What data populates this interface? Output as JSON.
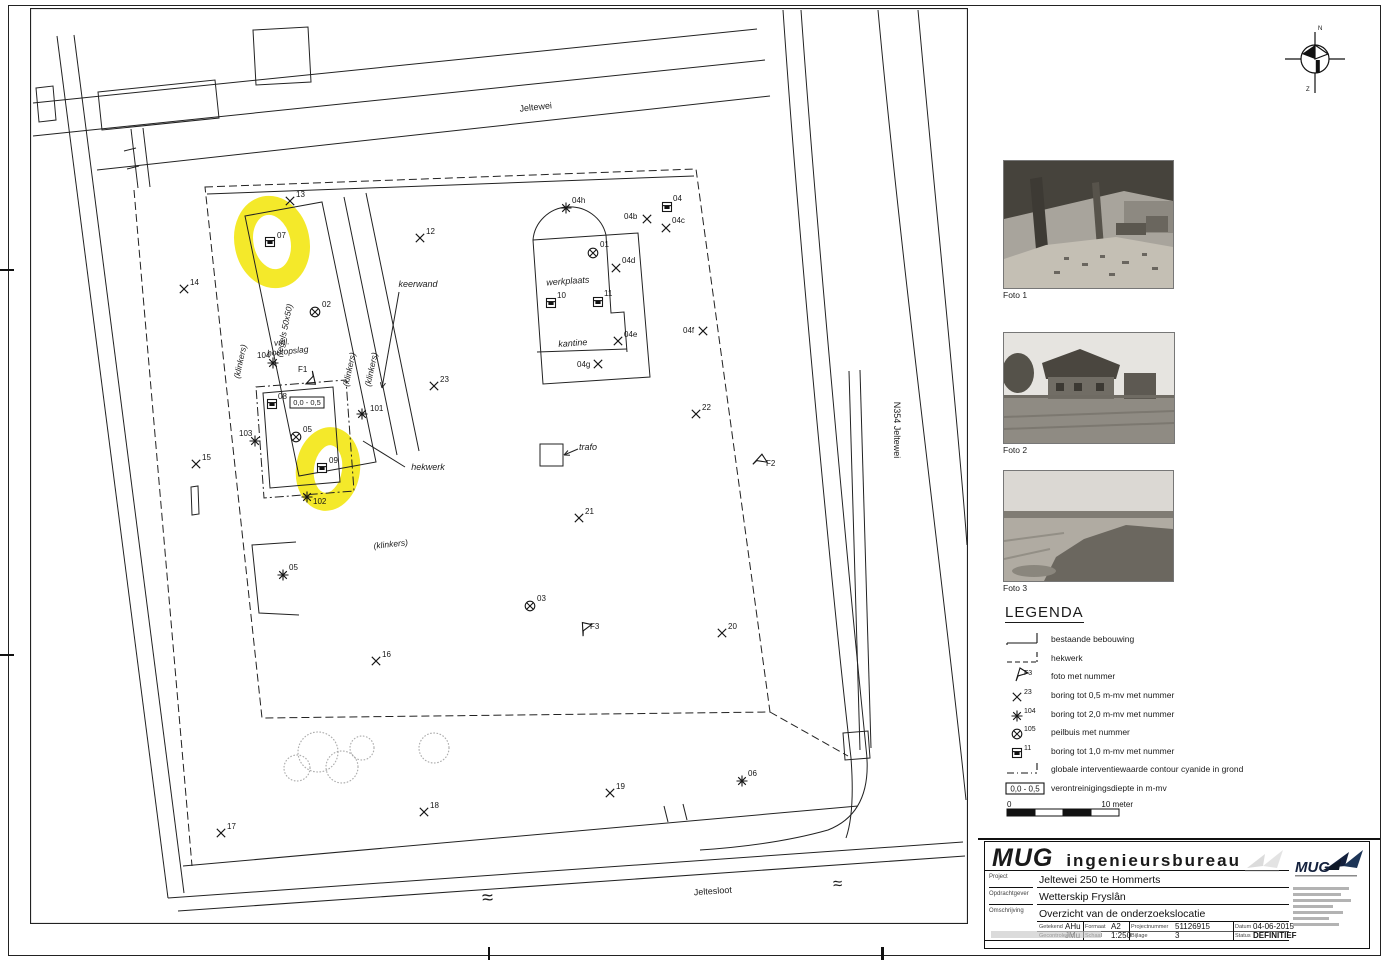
{
  "north": {
    "top": "N",
    "bottom": "Z"
  },
  "photos": [
    {
      "caption": "Foto 1"
    },
    {
      "caption": "Foto 2"
    },
    {
      "caption": "Foto 3"
    }
  ],
  "legend": {
    "title": "LEGENDA",
    "items": [
      {
        "sym": "bldg",
        "num": "",
        "label": "bestaande bebouwing"
      },
      {
        "sym": "fence",
        "num": "",
        "label": "hekwerk"
      },
      {
        "sym": "flag",
        "num": "F3",
        "label": "foto met nummer"
      },
      {
        "sym": "x",
        "num": "23",
        "label": "boring tot 0,5 m-mv met nummer"
      },
      {
        "sym": "star",
        "num": "104",
        "label": "boring tot 2,0 m-mv met nummer"
      },
      {
        "sym": "pb",
        "num": "105",
        "label": "peilbuis met nummer"
      },
      {
        "sym": "sq",
        "num": "11",
        "label": "boring tot 1,0 m-mv met nummer"
      },
      {
        "sym": "contour",
        "num": "",
        "label": "globale interventiewaarde contour cyanide in grond"
      },
      {
        "sym": "depth",
        "num": "0,0 - 0,5",
        "label": "verontreinigingsdiepte in m-mv"
      }
    ],
    "scale": {
      "left": "0",
      "right": "10 meter"
    }
  },
  "titleblock": {
    "company": "MUG",
    "company2": "ingenieursbureau",
    "logo": "MUG",
    "rows": [
      {
        "label": "Project",
        "value": "Jeltewei 250 te Hommerts"
      },
      {
        "label": "Opdrachtgever",
        "value": "Wetterskip Fryslân"
      },
      {
        "label": "Omschrijving",
        "value": "Overzicht van de onderzoekslocatie"
      }
    ],
    "fields": [
      [
        {
          "label": "Getekend",
          "value": "AHu"
        },
        {
          "label": "Formaat",
          "value": "A2"
        },
        {
          "label": "Projectnummer",
          "value": "51126915"
        },
        {
          "label": "Datum",
          "value": "04-06-2015"
        }
      ],
      [
        {
          "label": "Gecontroleerd",
          "value": "JMu"
        },
        {
          "label": "Schaal",
          "value": "1:250"
        },
        {
          "label": "Bijlage",
          "value": "3"
        },
        {
          "label": "Status",
          "value": "DEFINITIEF"
        }
      ]
    ]
  },
  "map": {
    "highlight_color": "#f3e713",
    "labels": [
      {
        "text": "Jeltewei",
        "x": 536,
        "y": 110,
        "rot": -6,
        "italic": false,
        "size": 9
      },
      {
        "text": "N354  Jeltewei",
        "x": 894,
        "y": 430,
        "rot": 90,
        "italic": false,
        "size": 9
      },
      {
        "text": "Jeltesloot",
        "x": 713,
        "y": 894,
        "rot": -4,
        "italic": false,
        "size": 9
      },
      {
        "text": "werkplaats",
        "x": 568,
        "y": 284,
        "rot": -4,
        "italic": true,
        "size": 9
      },
      {
        "text": "kantine",
        "x": 573,
        "y": 346,
        "rot": -4,
        "italic": true,
        "size": 9
      },
      {
        "text": "trafo",
        "x": 588,
        "y": 450,
        "rot": 0,
        "italic": true,
        "size": 9
      },
      {
        "text": "keerwand",
        "x": 418,
        "y": 287,
        "rot": 0,
        "italic": true,
        "size": 9
      },
      {
        "text": "hekwerk",
        "x": 428,
        "y": 470,
        "rot": 0,
        "italic": true,
        "size": 9
      },
      {
        "text": "(klinkers)",
        "x": 243,
        "y": 362,
        "rot": -78,
        "italic": true,
        "size": 8.5
      },
      {
        "text": "(klinkers)",
        "x": 352,
        "y": 370,
        "rot": -78,
        "italic": true,
        "size": 8.5
      },
      {
        "text": "(klinkers)",
        "x": 374,
        "y": 370,
        "rot": -78,
        "italic": true,
        "size": 8.5
      },
      {
        "text": "(klinkers)",
        "x": 391,
        "y": 547,
        "rot": -6,
        "italic": true,
        "size": 8.5
      },
      {
        "text": "(tegels 50x50)",
        "x": 287,
        "y": 331,
        "rot": -78,
        "italic": true,
        "size": 8.5
      },
      {
        "text": "vml.",
        "x": 282,
        "y": 345,
        "rot": -6,
        "italic": true,
        "size": 8.5
      },
      {
        "text": "houtopslag",
        "x": 288,
        "y": 354,
        "rot": -6,
        "italic": true,
        "size": 8.5
      },
      {
        "text": "≈",
        "x": 488,
        "y": 904,
        "rot": -4,
        "italic": false,
        "size": 20
      },
      {
        "text": "≈",
        "x": 838,
        "y": 889,
        "rot": -4,
        "italic": false,
        "size": 17
      }
    ],
    "boxed": [
      {
        "text": "0,0 - 0,5",
        "x": 290,
        "y": 397,
        "w": 34,
        "h": 11
      }
    ],
    "leaders": [
      {
        "x1": 578,
        "y1": 449,
        "x2": 564,
        "y2": 455,
        "arrow": true
      },
      {
        "x1": 399,
        "y1": 292,
        "x2": 382,
        "y2": 388,
        "arrow": true
      },
      {
        "x1": 405,
        "y1": 467,
        "x2": 363,
        "y2": 441,
        "arrow": false
      }
    ],
    "markers": [
      {
        "t": "x",
        "x": 420,
        "y": 238,
        "n": "12",
        "lx": 426,
        "ly": 234
      },
      {
        "t": "x",
        "x": 290,
        "y": 201,
        "n": "13",
        "lx": 296,
        "ly": 197
      },
      {
        "t": "x",
        "x": 184,
        "y": 289,
        "n": "14",
        "lx": 190,
        "ly": 285
      },
      {
        "t": "x",
        "x": 196,
        "y": 464,
        "n": "15",
        "lx": 202,
        "ly": 460
      },
      {
        "t": "x",
        "x": 376,
        "y": 661,
        "n": "16",
        "lx": 382,
        "ly": 657
      },
      {
        "t": "x",
        "x": 221,
        "y": 833,
        "n": "17",
        "lx": 227,
        "ly": 829
      },
      {
        "t": "x",
        "x": 424,
        "y": 812,
        "n": "18",
        "lx": 430,
        "ly": 808
      },
      {
        "t": "x",
        "x": 610,
        "y": 793,
        "n": "19",
        "lx": 616,
        "ly": 789
      },
      {
        "t": "x",
        "x": 722,
        "y": 633,
        "n": "20",
        "lx": 728,
        "ly": 629
      },
      {
        "t": "x",
        "x": 579,
        "y": 518,
        "n": "21",
        "lx": 585,
        "ly": 514
      },
      {
        "t": "x",
        "x": 696,
        "y": 414,
        "n": "22",
        "lx": 702,
        "ly": 410
      },
      {
        "t": "x",
        "x": 434,
        "y": 386,
        "n": "23",
        "lx": 440,
        "ly": 382
      },
      {
        "t": "x",
        "x": 647,
        "y": 219,
        "n": "04b",
        "lx": 624,
        "ly": 219
      },
      {
        "t": "x",
        "x": 666,
        "y": 228,
        "n": "04c",
        "lx": 672,
        "ly": 223
      },
      {
        "t": "x",
        "x": 616,
        "y": 268,
        "n": "04d",
        "lx": 622,
        "ly": 263
      },
      {
        "t": "x",
        "x": 618,
        "y": 341,
        "n": "04e",
        "lx": 624,
        "ly": 337
      },
      {
        "t": "x",
        "x": 703,
        "y": 331,
        "n": "04f",
        "lx": 683,
        "ly": 333
      },
      {
        "t": "x",
        "x": 598,
        "y": 364,
        "n": "04g",
        "lx": 577,
        "ly": 367
      },
      {
        "t": "star",
        "x": 566,
        "y": 208,
        "n": "04h",
        "lx": 572,
        "ly": 203
      },
      {
        "t": "star",
        "x": 362,
        "y": 414,
        "n": "101",
        "lx": 370,
        "ly": 411
      },
      {
        "t": "star",
        "x": 307,
        "y": 497,
        "n": "102",
        "lx": 313,
        "ly": 504
      },
      {
        "t": "star",
        "x": 255,
        "y": 441,
        "n": "103",
        "lx": 239,
        "ly": 436
      },
      {
        "t": "star",
        "x": 273,
        "y": 363,
        "n": "104",
        "lx": 257,
        "ly": 358
      },
      {
        "t": "star",
        "x": 283,
        "y": 575,
        "n": "05",
        "lx": 289,
        "ly": 570
      },
      {
        "t": "star",
        "x": 742,
        "y": 781,
        "n": "06",
        "lx": 748,
        "ly": 776
      },
      {
        "t": "pb",
        "x": 593,
        "y": 253,
        "n": "01",
        "lx": 600,
        "ly": 247
      },
      {
        "t": "pb",
        "x": 315,
        "y": 312,
        "n": "02",
        "lx": 322,
        "ly": 307
      },
      {
        "t": "pb",
        "x": 530,
        "y": 606,
        "n": "03",
        "lx": 537,
        "ly": 601
      },
      {
        "t": "pb",
        "x": 296,
        "y": 437,
        "n": "05",
        "lx": 303,
        "ly": 432
      },
      {
        "t": "sq",
        "x": 667,
        "y": 207,
        "n": "04",
        "lx": 673,
        "ly": 201
      },
      {
        "t": "sq",
        "x": 270,
        "y": 242,
        "n": "07",
        "lx": 277,
        "ly": 238
      },
      {
        "t": "sq",
        "x": 272,
        "y": 404,
        "n": "08",
        "lx": 278,
        "ly": 399
      },
      {
        "t": "sq",
        "x": 322,
        "y": 468,
        "n": "09",
        "lx": 329,
        "ly": 463
      },
      {
        "t": "sq",
        "x": 551,
        "y": 303,
        "n": "10",
        "lx": 557,
        "ly": 298
      },
      {
        "t": "sq",
        "x": 598,
        "y": 302,
        "n": "11",
        "lx": 604,
        "ly": 296
      },
      {
        "t": "flag",
        "x": 313,
        "y": 374,
        "n": "F1",
        "lx": 298,
        "ly": 372,
        "rot": 150
      },
      {
        "t": "flag",
        "x": 755,
        "y": 462,
        "n": "F2",
        "lx": 766,
        "ly": 466,
        "rot": 25
      },
      {
        "t": "flag",
        "x": 583,
        "y": 633,
        "n": "F3",
        "lx": 590,
        "ly": 629,
        "rot": -20
      }
    ],
    "highlights": [
      {
        "cx": 272,
        "cy": 242,
        "rx": 28,
        "ry": 37,
        "rot": -12,
        "w": 19
      },
      {
        "cx": 328,
        "cy": 469,
        "rx": 23,
        "ry": 33,
        "rot": 8,
        "w": 18
      }
    ]
  }
}
